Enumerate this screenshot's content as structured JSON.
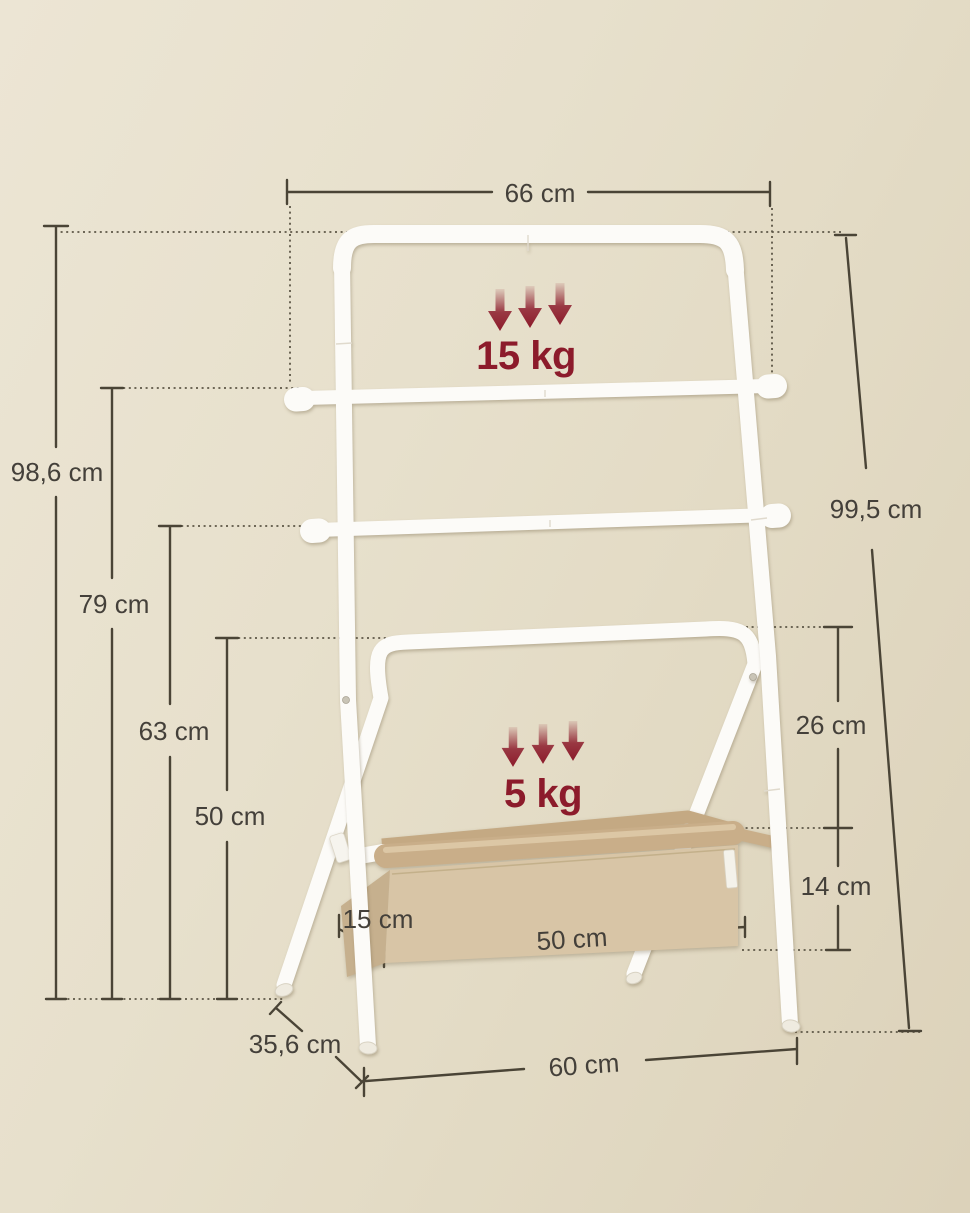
{
  "page": {
    "title": "Ladder towel rack with storage basket - dimension diagram"
  },
  "palette": {
    "background_light": "#ece5d4",
    "background_dark": "#dcd2ba",
    "dimension_line": "#4a4436",
    "label_text": "#44403a",
    "load_accent_red": "#8c1b2b",
    "tube_white": "#fcfbf8",
    "basket_front": "#d8c5a6",
    "basket_side": "#c6b08e",
    "basket_roll": "#c9ae89"
  },
  "dimensions": {
    "top_width": "66 cm",
    "height_left_total": "98,6 cm",
    "height_bar2": "79 cm",
    "height_bar3": "63 cm",
    "height_bar4": "50 cm",
    "height_right_total": "99,5 cm",
    "bar4_to_basket": "26 cm",
    "basket_height": "14 cm",
    "basket_depth": "15 cm",
    "basket_width": "50 cm",
    "base_depth": "35,6 cm",
    "base_width": "60 cm"
  },
  "loads": {
    "top_bars": "15 kg",
    "basket": "5 kg"
  }
}
